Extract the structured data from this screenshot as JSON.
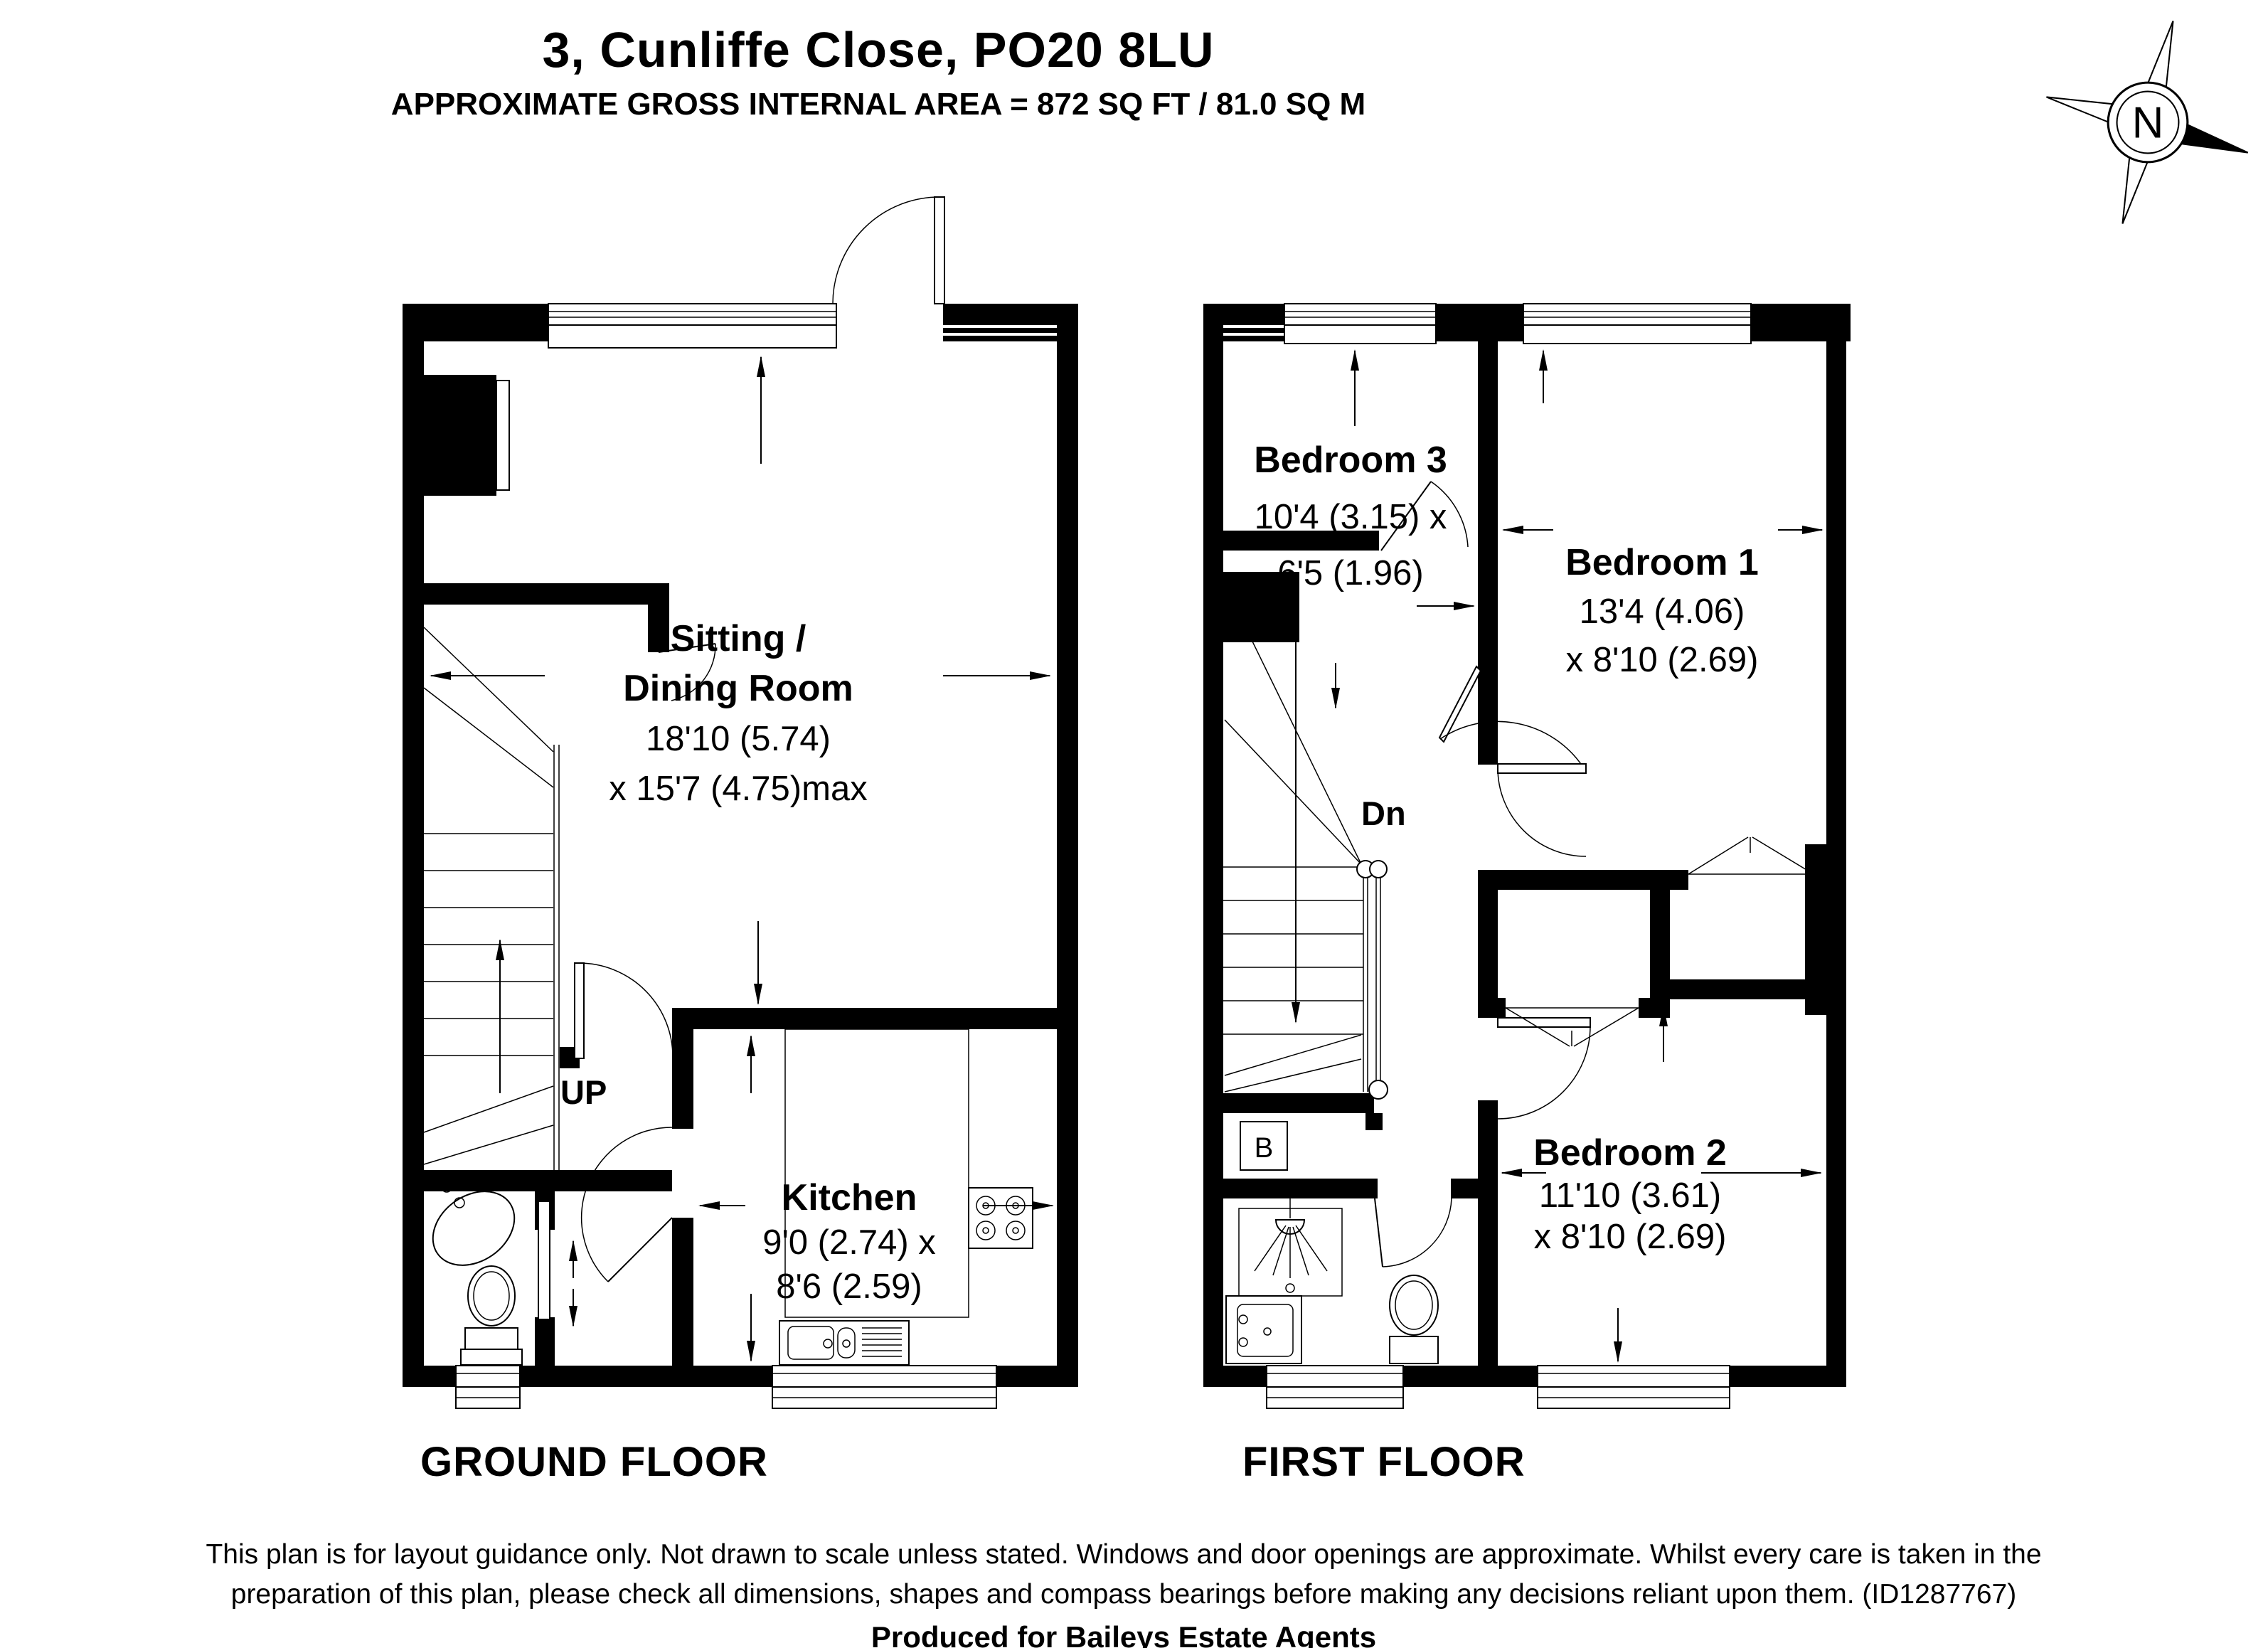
{
  "header": {
    "title": "3, Cunliffe Close, PO20 8LU",
    "subtitle": "APPROXIMATE GROSS INTERNAL AREA = 872 SQ FT / 81.0 SQ M"
  },
  "compass": {
    "letter": "N"
  },
  "ground": {
    "floor_label": "GROUND FLOOR",
    "sitting": {
      "name1": "Sitting /",
      "name2": "Dining Room",
      "dim1": "18'10 (5.74)",
      "dim2": "x 15'7 (4.75)max"
    },
    "kitchen": {
      "name": "Kitchen",
      "dim1": "9'0 (2.74) x",
      "dim2": "8'6 (2.59)"
    },
    "stairs_label": "UP"
  },
  "first": {
    "floor_label": "FIRST FLOOR",
    "bedroom1": {
      "name": "Bedroom 1",
      "dim1": "13'4 (4.06)",
      "dim2": "x 8'10 (2.69)"
    },
    "bedroom2": {
      "name": "Bedroom 2",
      "dim1": "11'10 (3.61)",
      "dim2": "x 8'10 (2.69)"
    },
    "bedroom3": {
      "name": "Bedroom 3",
      "dim1": "10'4 (3.15) x",
      "dim2": "6'5 (1.96)"
    },
    "stairs_label": "Dn",
    "boiler_label": "B"
  },
  "footer": {
    "disclaimer": "This plan is for layout guidance only. Not drawn to scale unless stated. Windows and door openings are approximate. Whilst every care is taken in the preparation of this plan, please check all dimensions, shapes and compass bearings before making any decisions reliant upon them. (ID1287767)",
    "produced_for": "Produced for Baileys Estate Agents"
  },
  "colors": {
    "wall": "#000000",
    "background": "#ffffff"
  }
}
